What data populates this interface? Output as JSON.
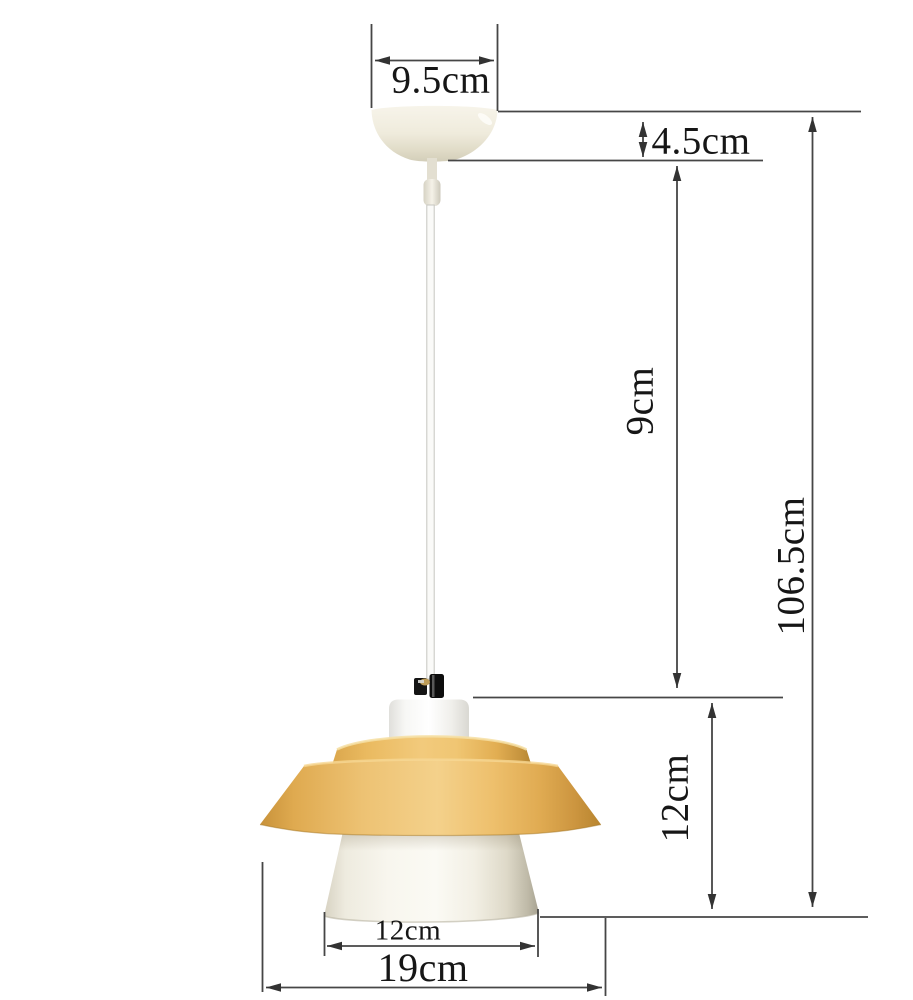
{
  "diagram": {
    "subject": "pendant-lamp-dimension-diagram",
    "dimensions": {
      "canopy_diameter": "9.5cm",
      "canopy_height": "4.5cm",
      "upper_cord_length": "9cm",
      "overall_height": "106.5cm",
      "shade_height": "12cm",
      "opening_diameter": "12cm",
      "shade_diameter": "19cm"
    },
    "colors": {
      "wood_shade": "#eec273",
      "ivory_parts": "#f2efe2",
      "dimension_line": "#464646",
      "label_text": "#161616",
      "background": "#ffffff"
    }
  }
}
